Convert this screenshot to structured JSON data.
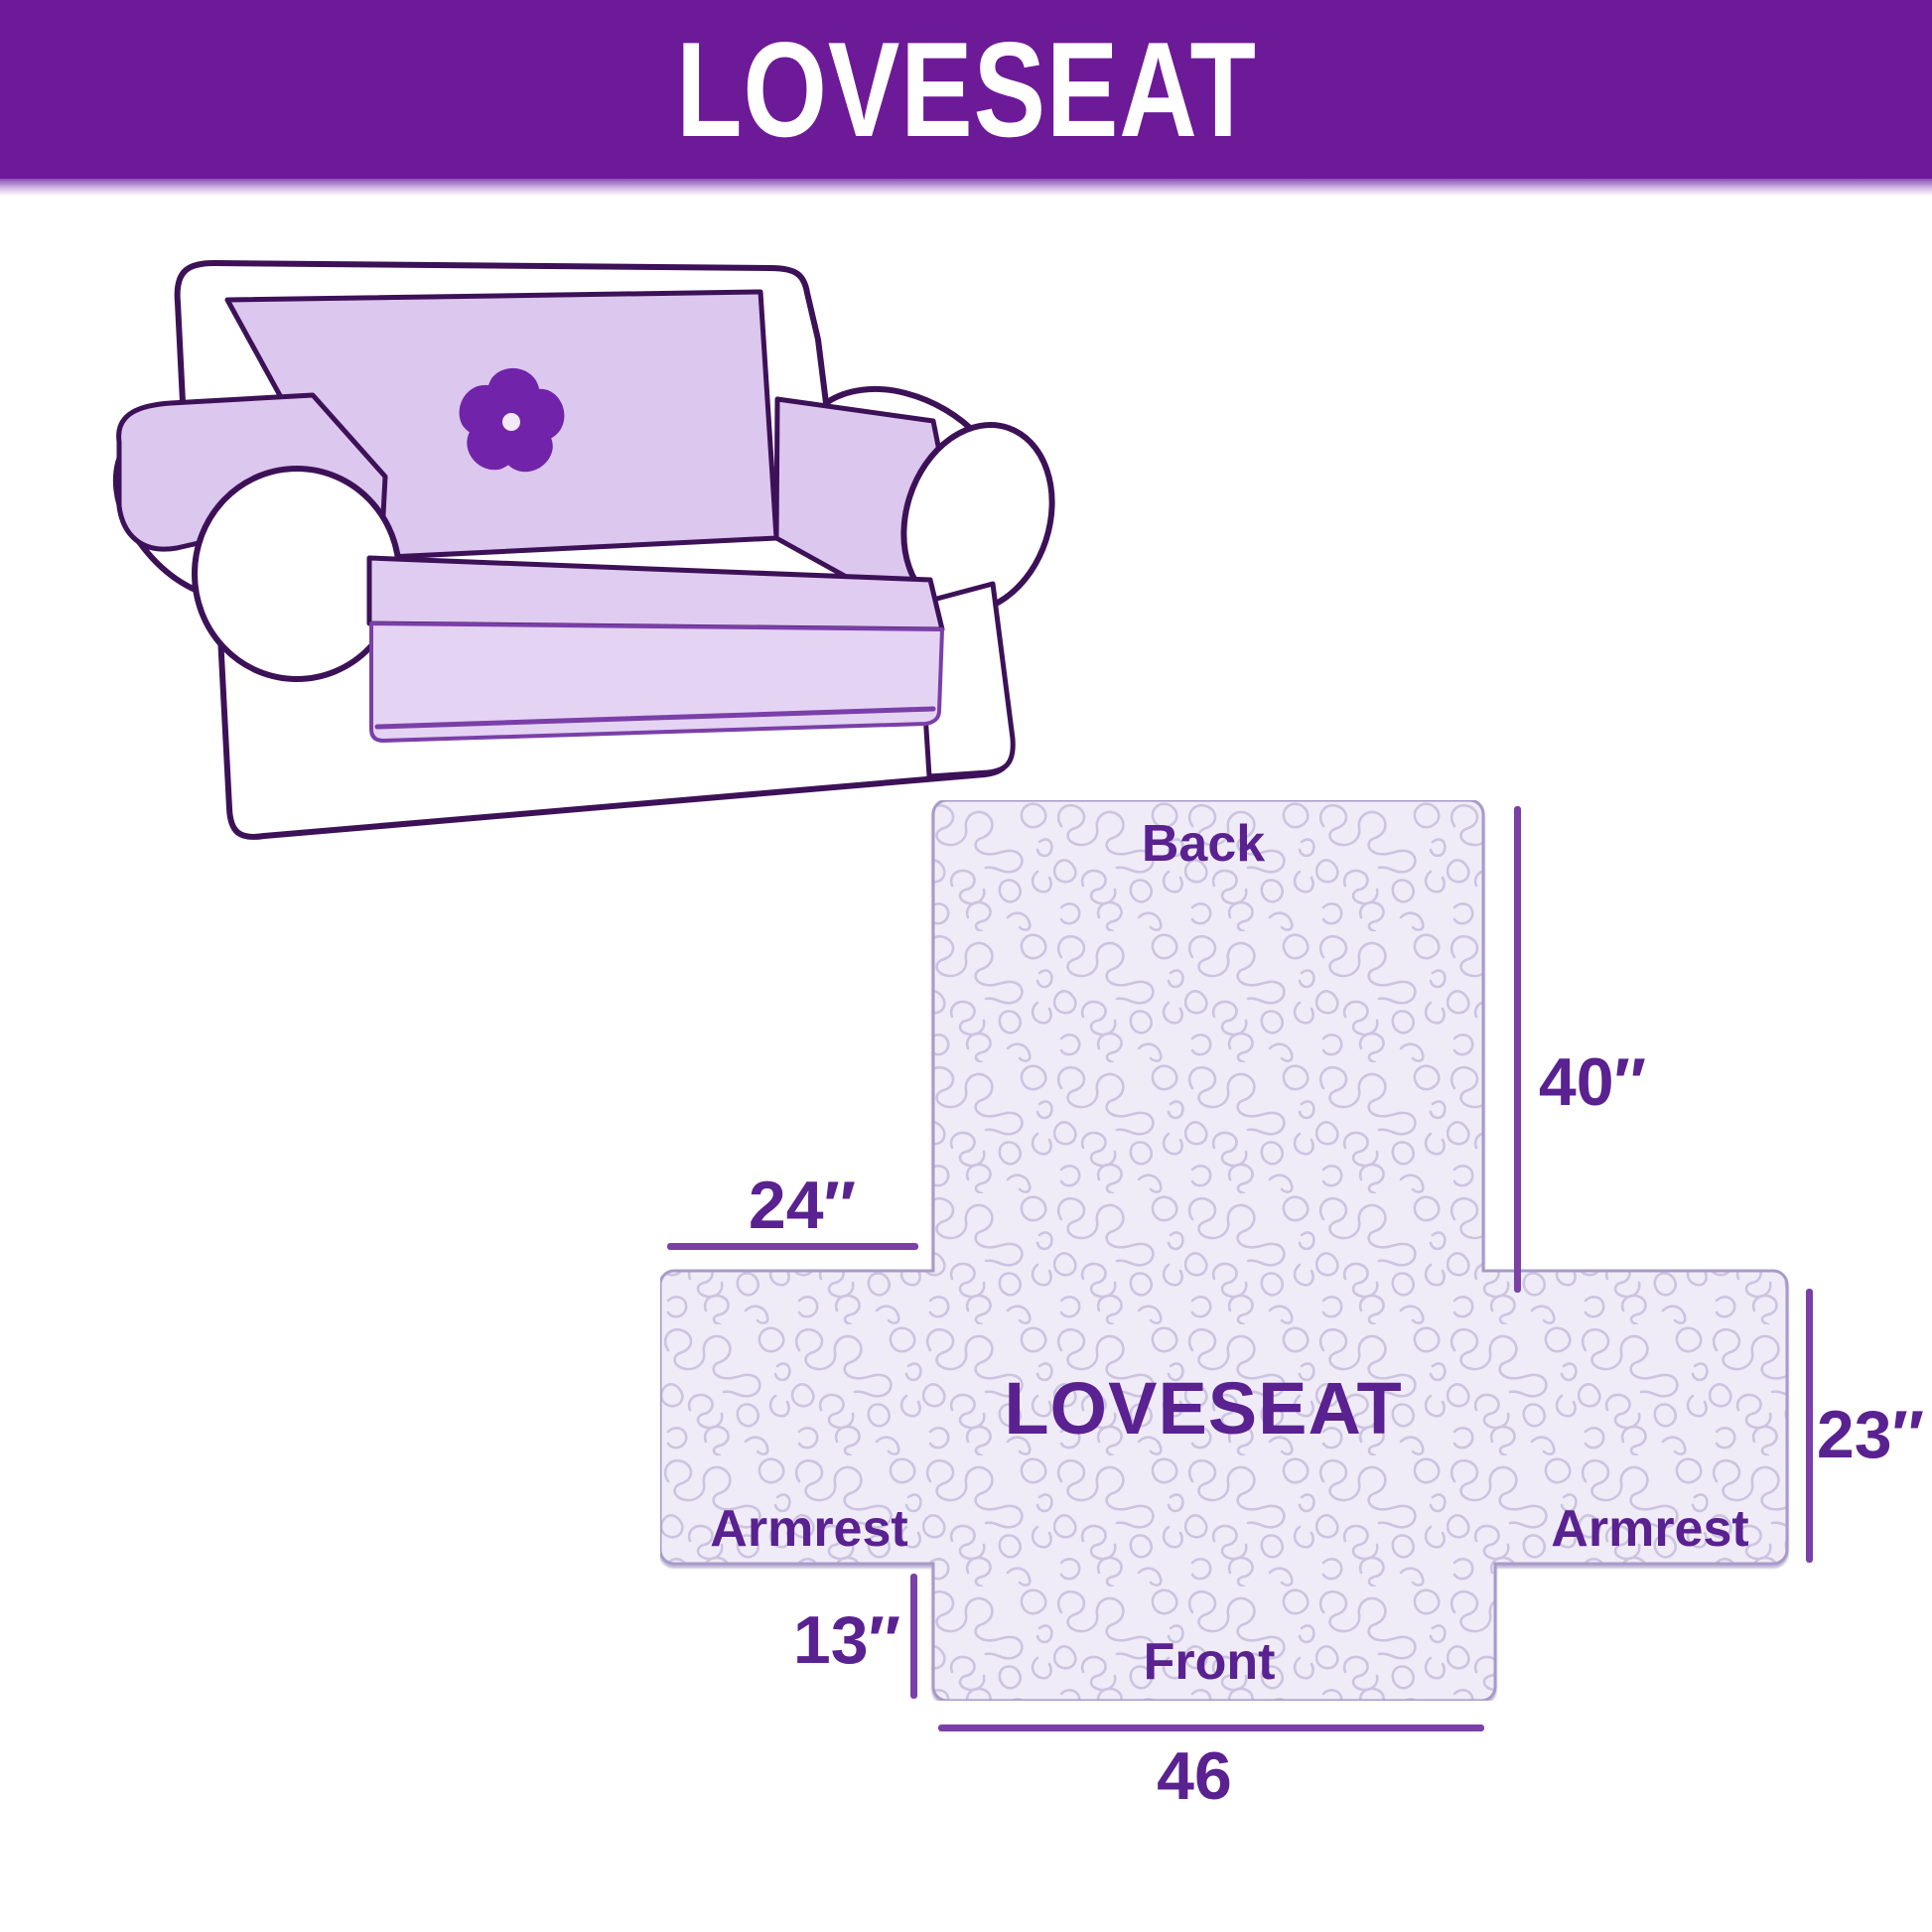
{
  "banner": {
    "title": "LOVESEAT",
    "bg_color": "#6C1A97",
    "text_color": "#FFFFFF"
  },
  "couch": {
    "logo_icon": "pinwheel-flower-icon",
    "cover_color": "#DCC7EE",
    "skirt_color": "#E5D3F4",
    "outline_color": "#3D1158",
    "logo_color": "#7124A9"
  },
  "diagram": {
    "center_label": "LOVESEAT",
    "back_label": "Back",
    "front_label": "Front",
    "armrest_left_label": "Armrest",
    "armrest_right_label": "Armrest",
    "dim_back_height": "40″",
    "dim_armrest_top_width": "24″",
    "dim_armrest_height": "23″",
    "dim_front_height": "13″",
    "dim_front_width": "46",
    "fill_color": "#EFECF8",
    "pattern_color": "#CCC4E0",
    "border_color": "#A89BC8",
    "label_color": "#5A2191",
    "dim_line_color": "#7B3FA8"
  }
}
